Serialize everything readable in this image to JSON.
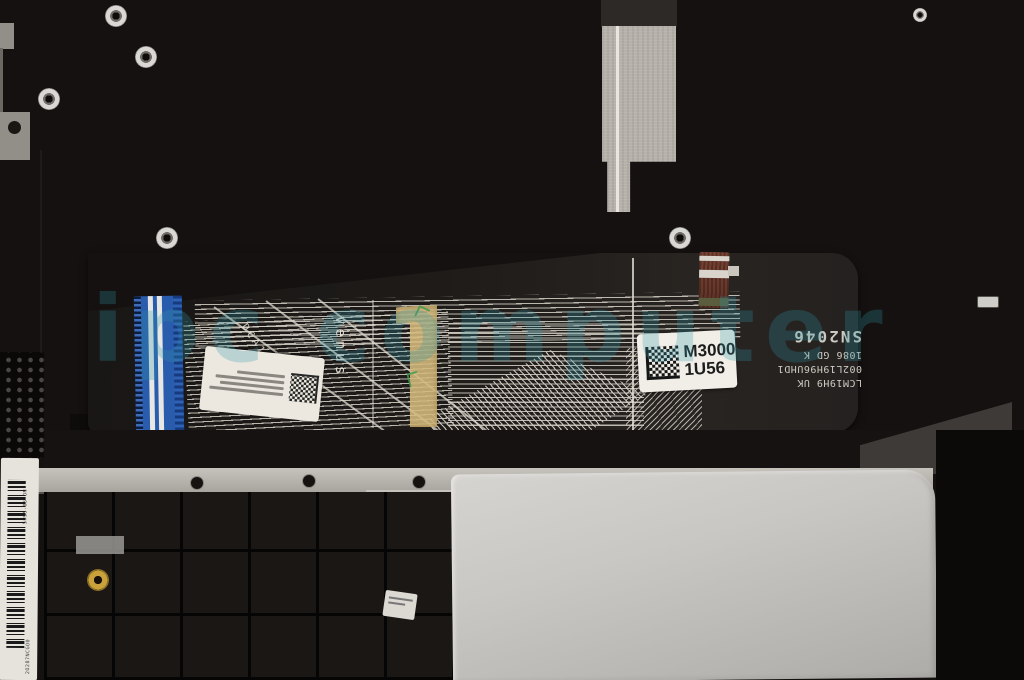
{
  "meta": {
    "description": "Product photo: underside of a laptop palmrest/keyboard assembly with black flex ribbon cable, blue FFC connector, kapton tape and touchpad plate"
  },
  "watermark": {
    "text": "ipc computer",
    "color": "#2f97a8"
  },
  "flex": {
    "venus_text": "venus",
    "dca_text": "DCA1-2",
    "part_label": {
      "line1": "M3000",
      "line2": "1U56"
    },
    "print_lines": [
      "LCM19H9 UK",
      "002L19H96UHD1",
      "1086 GD K",
      "SN2046"
    ]
  },
  "labels": {
    "serial_top": "5H95-05 ON",
    "serial_bottom": "2O287NCGO0"
  },
  "colors": {
    "connector_blue": "#2a5cad",
    "kapton_yellow": "#d4ba7c",
    "touchpad_silver": "#c9c7c3",
    "flex_dark": "#1e1b19"
  }
}
